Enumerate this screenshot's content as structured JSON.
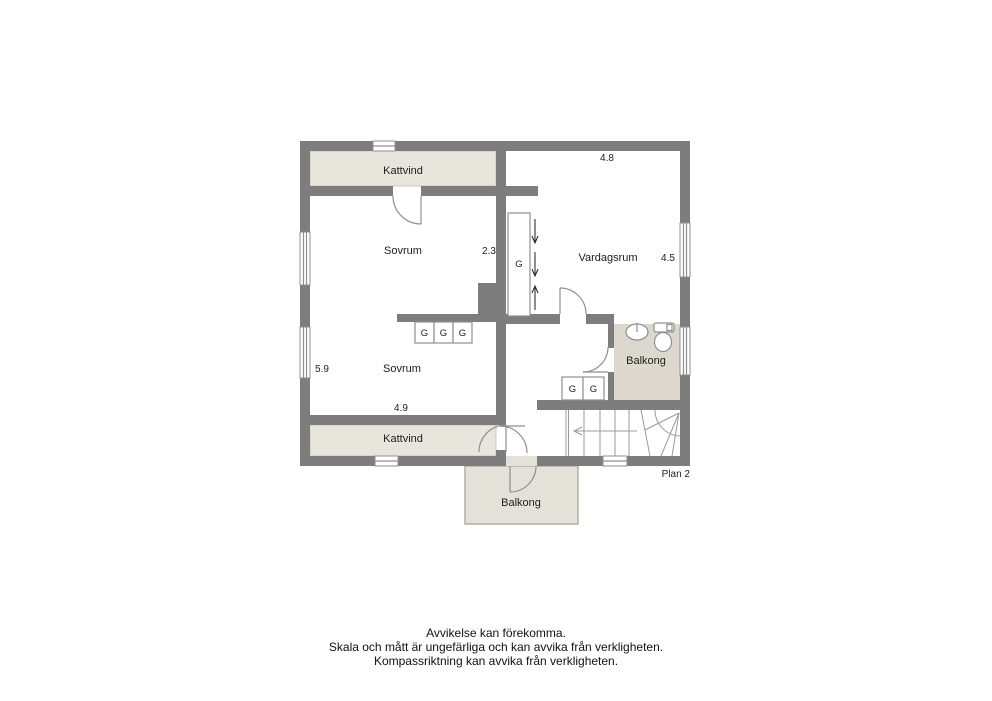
{
  "plan": {
    "label": "Plan 2",
    "rooms": {
      "kattvind_top": "Kattvind",
      "sovrum_top": "Sovrum",
      "vardagsrum": "Vardagsrum",
      "sovrum_bottom": "Sovrum",
      "kattvind_bottom": "Kattvind",
      "balkong_bath": "Balkong",
      "balkong_lower": "Balkong"
    },
    "wardrobe_label": "G",
    "dimensions": {
      "vardagsrum_top": "4.8",
      "vardagsrum_right": "4.5",
      "sovrum_top_right": "2.3",
      "sovrum_bottom_left": "5.9",
      "sovrum_bottom_width": "4.9"
    },
    "colors": {
      "wall": "#7d7d7d",
      "room_light": "#e8e5dd",
      "bath_floor": "#dcd8ce",
      "balcony_floor": "#e4e1d8",
      "outline": "#8f8f8f",
      "text": "#1d1d1d"
    }
  },
  "disclaimer": {
    "line1": "Avvikelse kan förekomma.",
    "line2": "Skala och mått är ungefärliga och kan avvika från verkligheten.",
    "line3": "Kompassriktning kan avvika från verkligheten."
  }
}
